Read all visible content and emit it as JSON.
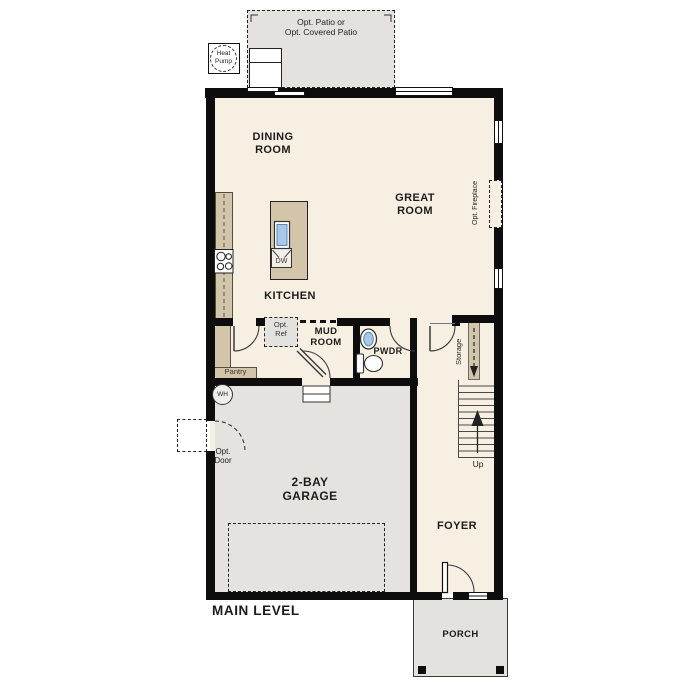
{
  "plan": {
    "level_label": "MAIN LEVEL",
    "outdoor": {
      "patio": {
        "line1": "Opt. Patio or",
        "line2": "Opt. Covered Patio"
      },
      "heat_pump": {
        "line1": "Heat",
        "line2": "Pump"
      },
      "porch": {
        "label": "PORCH"
      }
    },
    "rooms": {
      "dining": {
        "line1": "DINING",
        "line2": "ROOM"
      },
      "great": {
        "line1": "GREAT",
        "line2": "ROOM"
      },
      "kitchen": {
        "label": "KITCHEN"
      },
      "mud": {
        "line1": "MUD",
        "line2": "ROOM"
      },
      "pwdr": {
        "label": "PWDR"
      },
      "foyer": {
        "label": "FOYER"
      },
      "garage": {
        "line1": "2-BAY",
        "line2": "GARAGE"
      }
    },
    "features": {
      "dw": "DW",
      "opt_ref": {
        "line1": "Opt.",
        "line2": "Ref"
      },
      "pantry": "Pantry",
      "storage": "Storage",
      "up": "Up",
      "wh": "WH",
      "opt_door": {
        "line1": "Opt.",
        "line2": "Door"
      },
      "opt_fireplace": "Opt. Fireplace"
    },
    "colors": {
      "floor": "#f7efe2",
      "outdoor_concrete": "#e3e2df",
      "counter_tan": "#d3c5a9",
      "wall": "#0d0d0d",
      "sink_blue": "#a9c7e7"
    }
  }
}
